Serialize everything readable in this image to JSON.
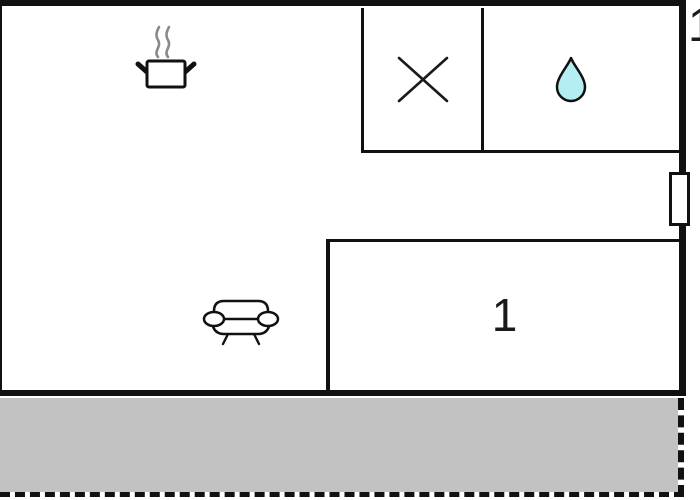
{
  "floorplan": {
    "unit_number_label": "1",
    "room_label": "1",
    "colors": {
      "wall": "#111111",
      "terrace_fill": "#c2c2c2",
      "water_drop_fill": "#b5eef2",
      "steam_gray": "#8a8a8a",
      "background": "#ffffff"
    },
    "icons": {
      "kitchen": "cooking-pot-icon",
      "bathroom_left_cell": "shower-cross-icon",
      "bathroom_right_cell": "water-drop-icon",
      "living_area": "sofa-icon",
      "right_wall_opening": "window-marker",
      "terrace_boundary": "dashed-line"
    }
  }
}
